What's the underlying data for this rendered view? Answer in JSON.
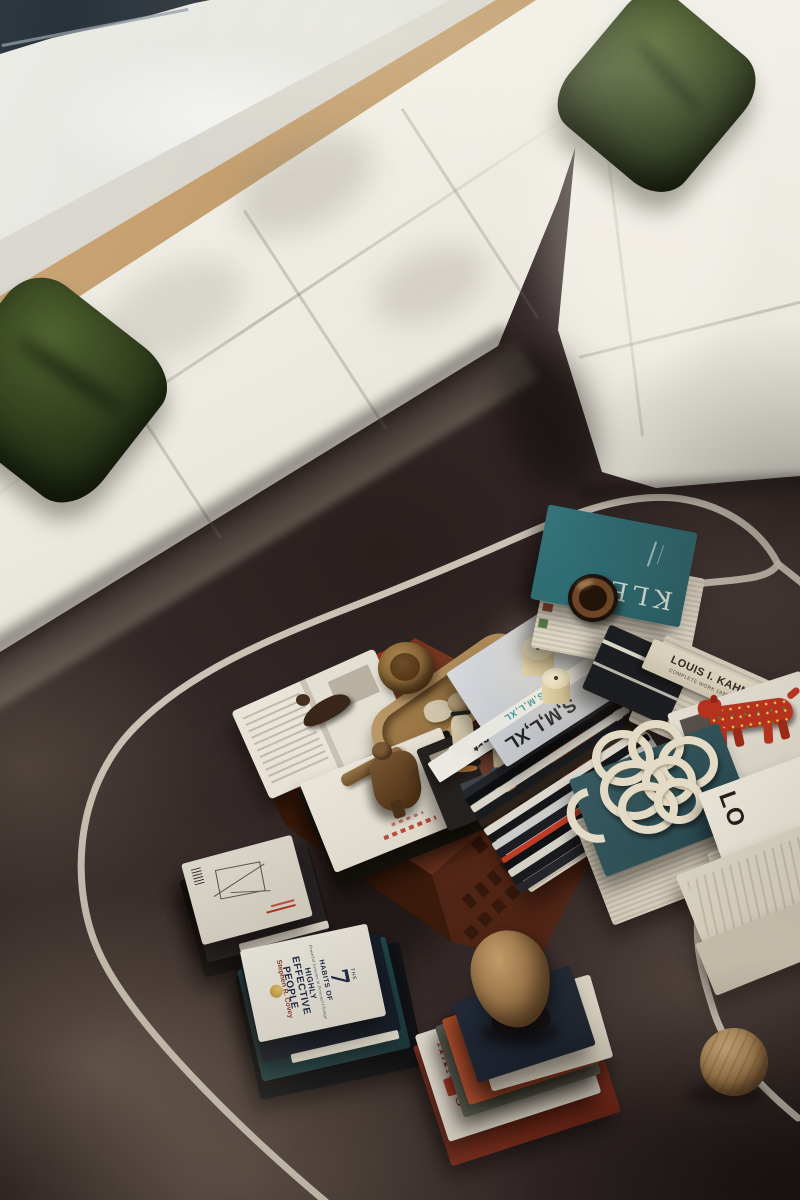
{
  "colors": {
    "rug": "#342928",
    "rugline": "#d8d0c1",
    "sofa": "#edebe3",
    "sofashadow": "#c8c4b6",
    "pillow": "#35431f",
    "pillowdark": "#1c2611",
    "floor": "#c5a173",
    "sill": "#e4e4de",
    "wall": "#d7d5cc",
    "frame": "#171b20",
    "table": "#7c3b24",
    "tableside": "#572817",
    "klee": "#2e6b72",
    "tealbook": "#2e4f55",
    "candle": "#ecdfbe",
    "rope": "#e4dbc6",
    "toy": "#b5321f",
    "red": "#c03a26",
    "navy": "#161d28",
    "gold": "#c9a34a",
    "silver": "#c9ccd0",
    "cream": "#ddd6c6"
  },
  "books": {
    "klee": {
      "title": "KLEE"
    },
    "smlxl": {
      "cover": "S,M,L,XL",
      "spine": "S,M,L,XL"
    },
    "wallpaper": {
      "spine": "wallpaper*"
    },
    "kahn": {
      "title": "LOUIS I. KAHN",
      "subtitle": "COMPLETE WORK 1935-1974"
    },
    "habits": {
      "the": "THE",
      "seven": "7",
      "l1": "HABITS OF",
      "tagline": "Powerful Lessons in Personal Change",
      "l2": "HIGHLY",
      "l3": "EFFECTIVE",
      "l4": "PEOPLE",
      "author": "Stephen R. Covey"
    },
    "sanyu": {
      "title": "SANYU"
    },
    "lo": {
      "title": "LO"
    }
  }
}
